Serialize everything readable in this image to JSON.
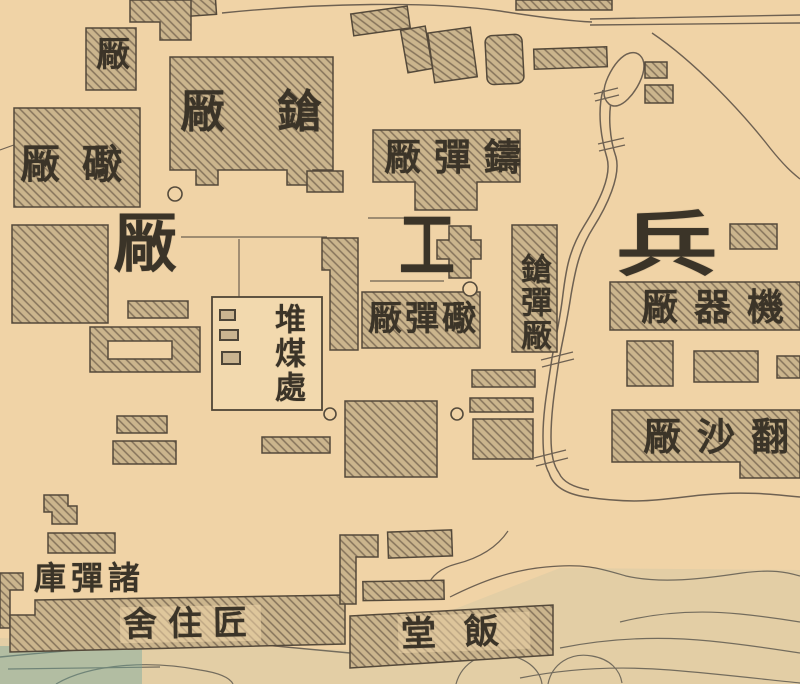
{
  "map": {
    "description_labels": {
      "small_factory": "厰",
      "rifle_factory": "厰鎗",
      "cannon_factory": "厰礮",
      "cast_shell_factory": "厰彈鑄",
      "shell_factory": "厰彈礮",
      "rifle_cartridge_factory": "鎗彈厰",
      "coal_depot": "堆煤處",
      "machine_factory": "厰器機",
      "foundry": "厰沙翻",
      "magazine": "庫彈諸",
      "workmen_quarters": "舍住匠",
      "dining_hall": "堂飯",
      "arsenal_big_left": "厰",
      "arsenal_big_middle": "工",
      "arsenal_big_right": "兵"
    },
    "colors": {
      "paper": "#f0d3a6",
      "building_fill": "#cbb58d",
      "ink": "#3b3428",
      "line": "#6e6152",
      "water_tint": "#6ea89e"
    }
  }
}
